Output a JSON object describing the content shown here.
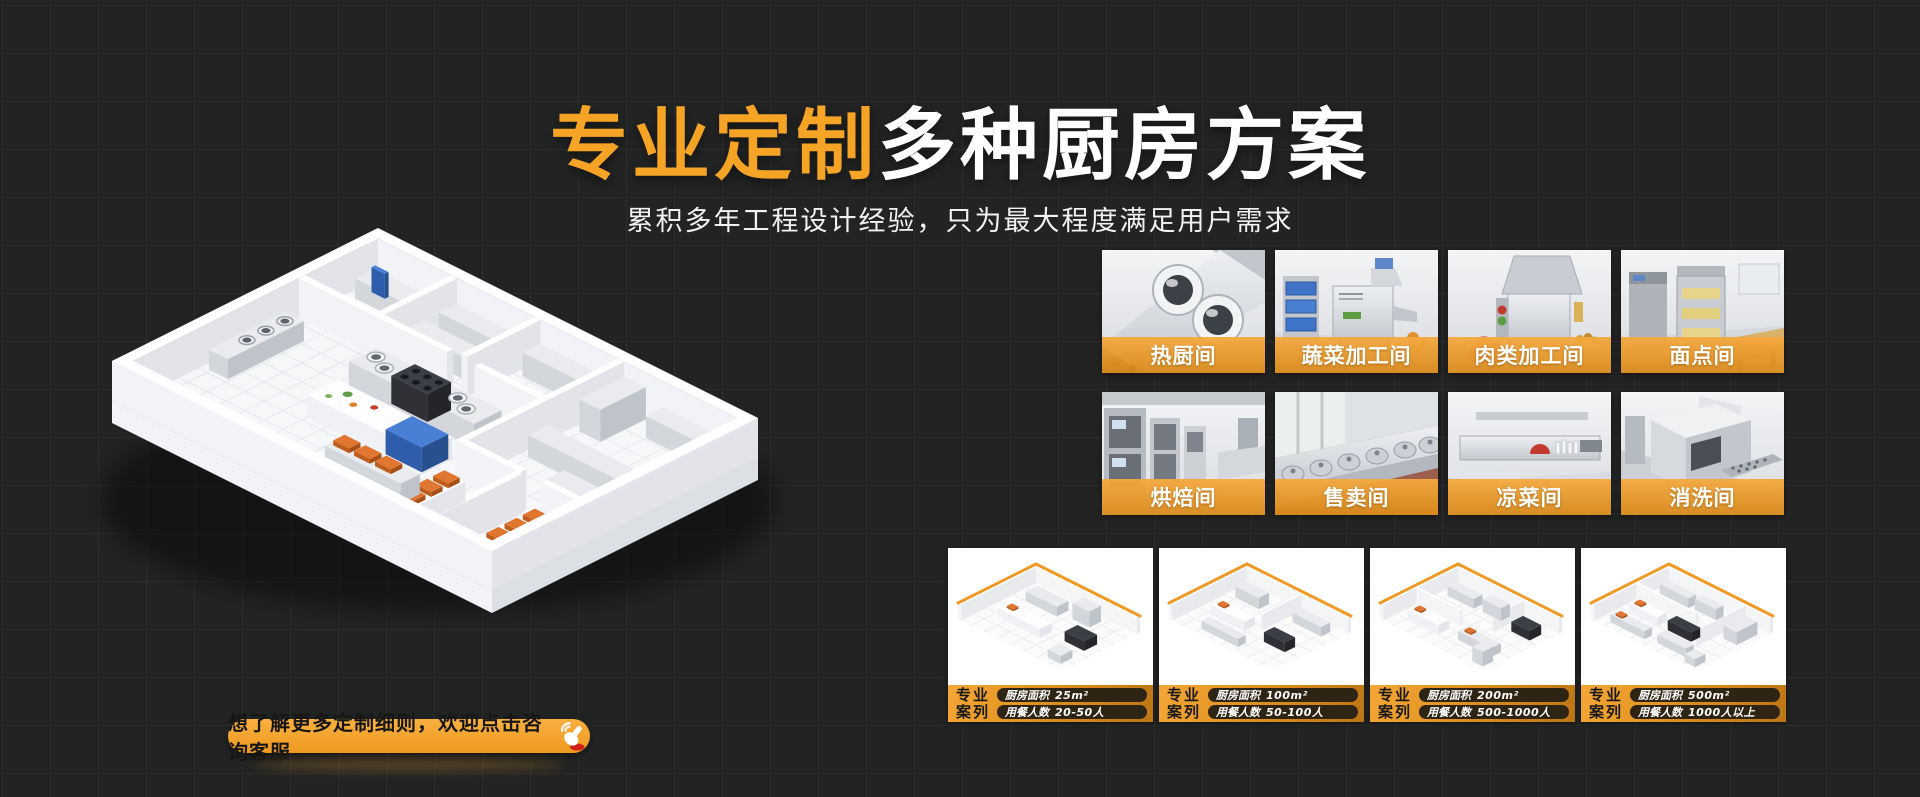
{
  "colors": {
    "accent": "#F6A426",
    "background": "#222323",
    "label_bar": "#E8A032"
  },
  "hero": {
    "title_highlight": "专业定制",
    "title_rest": "多种厨房方案",
    "subtitle": "累积多年工程设计经验，只为最大程度满足用户需求"
  },
  "rooms": [
    {
      "label": "热厨间"
    },
    {
      "label": "蔬菜加工间"
    },
    {
      "label": "肉类加工间"
    },
    {
      "label": "面点间"
    },
    {
      "label": "烘焙间"
    },
    {
      "label": "售卖间"
    },
    {
      "label": "凉菜间"
    },
    {
      "label": "消洗间"
    }
  ],
  "case_section": {
    "badge_top": "专业",
    "badge_bottom": "案列",
    "area_label": "厨房面积",
    "diners_label": "用餐人数"
  },
  "cases": [
    {
      "area": "25m²",
      "diners": "20-50人"
    },
    {
      "area": "100m²",
      "diners": "50-100人"
    },
    {
      "area": "200m²",
      "diners": "500-1000人"
    },
    {
      "area": "500m²",
      "diners": "1000人以上"
    }
  ],
  "cta": {
    "label": "想了解更多定制细则，欢迎点击咨询客服"
  }
}
